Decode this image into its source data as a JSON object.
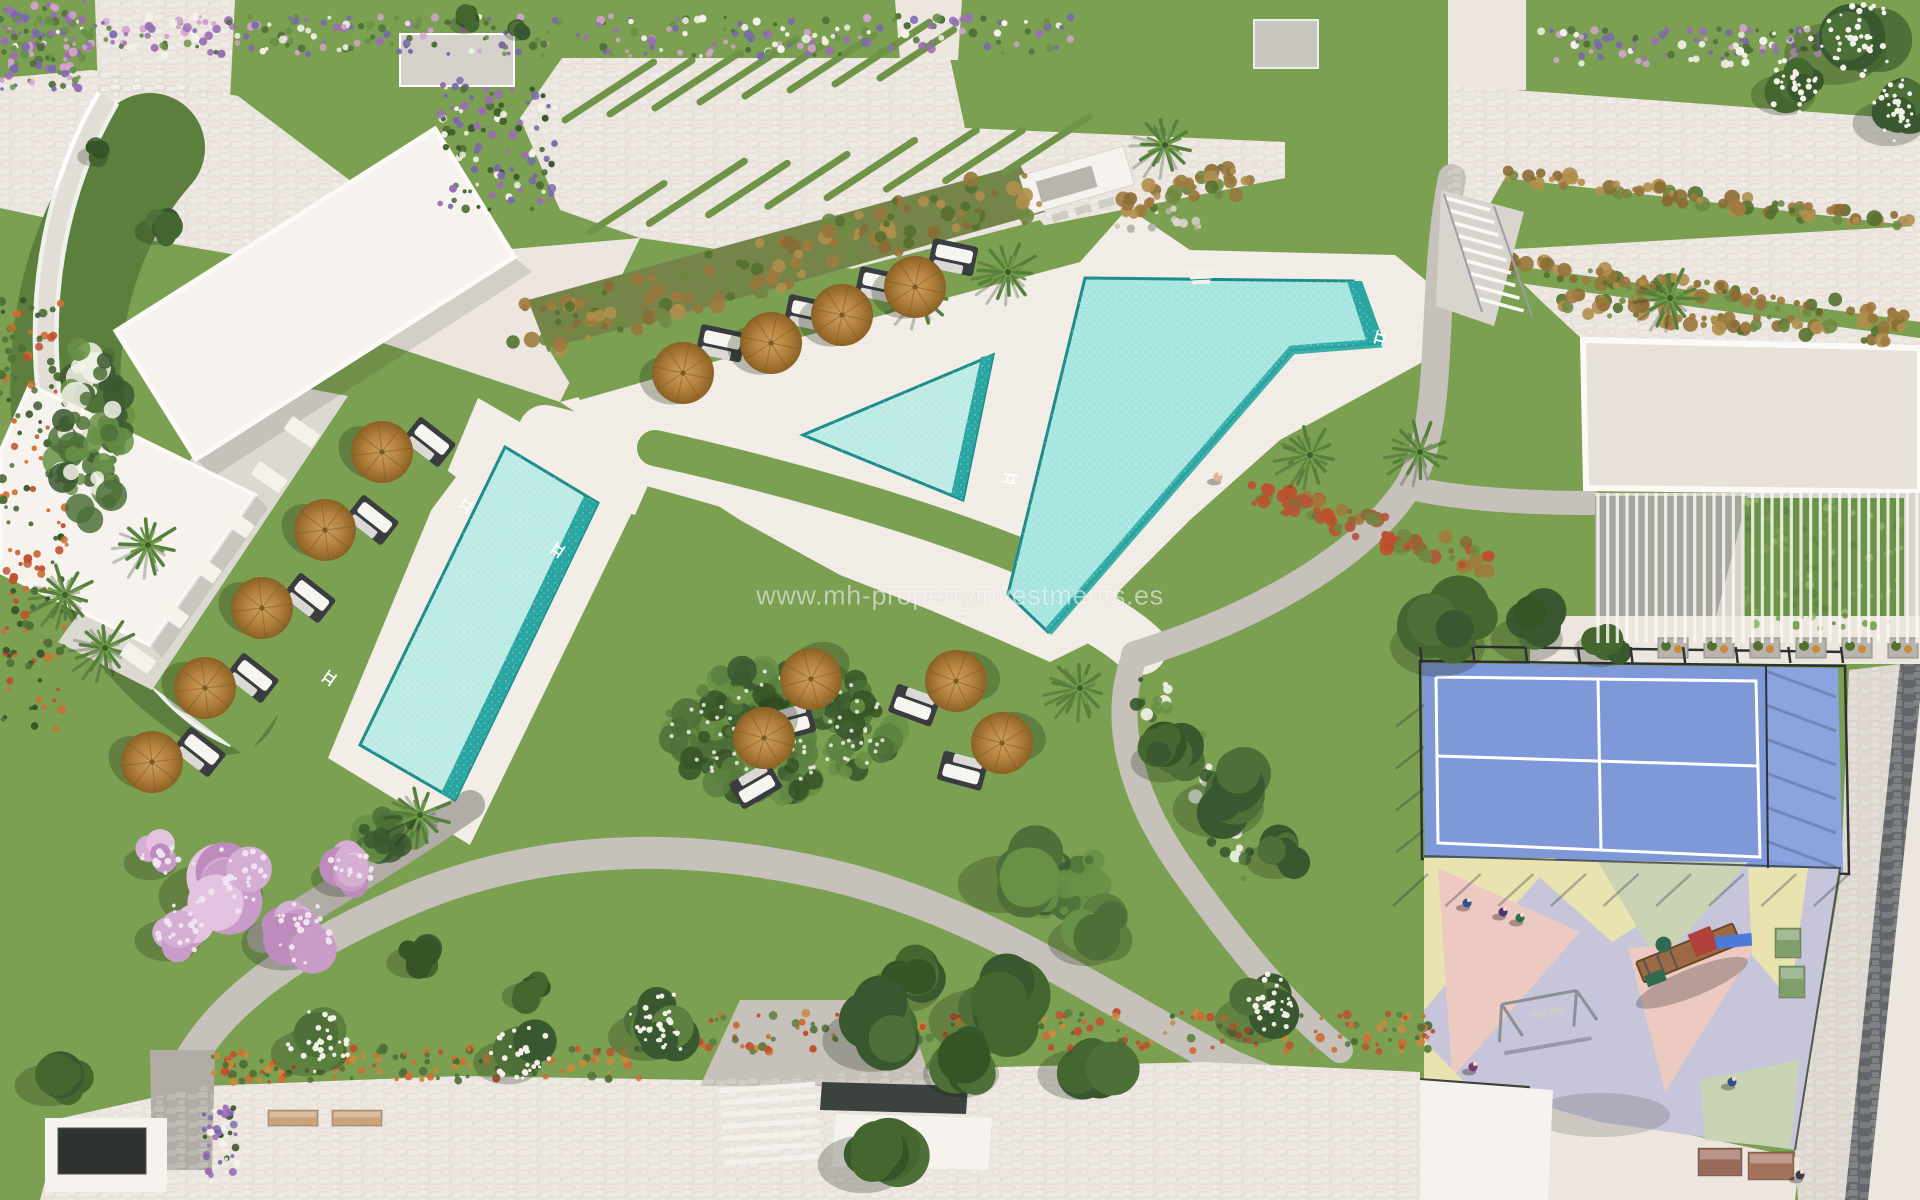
{
  "watermark": {
    "text": "www.mh-propertyinvestments.es"
  },
  "colors": {
    "grass": "#7ca051",
    "grassDark": "#5c7f3b",
    "paving": "#ece6df",
    "deck": "#f2ede6",
    "pathGray": "#c6c2bb",
    "pathDark": "#b1ada6",
    "cobbleLight": "#ded8d0",
    "cobbleDark": "#62666b",
    "poolLight": "#a7e6e0",
    "poolPale": "#bcebe5",
    "poolDeep": "#2aa6a2",
    "poolEdge": "#1d8c8a",
    "courtBlue": "#7e98d8",
    "courtBlue2": "#8ba3de",
    "courtLine": "#ffffff",
    "playLav": "#c6c5d9",
    "playYellow": "#e9e3af",
    "playPink": "#ecc9c1",
    "playSage": "#cbd3b5",
    "umbTop": "#b5813e",
    "umbDark": "#7e5a23",
    "mat": "#3a3d3f",
    "lounger": "#f7f5f0",
    "roofWhite": "#f6f3ee",
    "roofBeige": "#e7e1d9",
    "roofDark": "#3c423d",
    "boxGray": "#d5d2cc",
    "stripGreen": "#6f9447",
    "slope": "#75854a",
    "fence": "#2e3233",
    "watermark": "rgba(255,255,255,0.55)"
  },
  "scene": {
    "umbrellas": [
      {
        "x": 683,
        "y": 373,
        "a": 12
      },
      {
        "x": 771,
        "y": 343,
        "a": 12
      },
      {
        "x": 842,
        "y": 315,
        "a": 12
      },
      {
        "x": 915,
        "y": 287,
        "a": 12
      },
      {
        "x": 382,
        "y": 452,
        "a": 38
      },
      {
        "x": 325,
        "y": 530,
        "a": 38
      },
      {
        "x": 262,
        "y": 608,
        "a": 38
      },
      {
        "x": 205,
        "y": 688,
        "a": 38
      },
      {
        "x": 152,
        "y": 762,
        "a": 38
      },
      {
        "x": 811,
        "y": 679,
        "a": 165
      },
      {
        "x": 764,
        "y": 738,
        "a": 150
      },
      {
        "x": 956,
        "y": 681,
        "a": 200
      },
      {
        "x": 1002,
        "y": 743,
        "a": 195
      }
    ],
    "palms": [
      {
        "x": 148,
        "y": 545
      },
      {
        "x": 65,
        "y": 595
      },
      {
        "x": 105,
        "y": 648
      },
      {
        "x": 920,
        "y": 295
      },
      {
        "x": 1008,
        "y": 272
      },
      {
        "x": 1310,
        "y": 455
      },
      {
        "x": 1420,
        "y": 452
      },
      {
        "x": 1080,
        "y": 688
      },
      {
        "x": 1670,
        "y": 298
      },
      {
        "x": 1165,
        "y": 145
      },
      {
        "x": 420,
        "y": 815
      }
    ],
    "trees": [
      {
        "x": 1235,
        "y": 795,
        "r": 48,
        "t": "dark"
      },
      {
        "x": 1175,
        "y": 752,
        "r": 34,
        "t": "dark"
      },
      {
        "x": 1285,
        "y": 852,
        "r": 30,
        "t": "dark"
      },
      {
        "x": 1000,
        "y": 1005,
        "r": 55,
        "t": "dark"
      },
      {
        "x": 1092,
        "y": 1062,
        "r": 42,
        "t": "dark"
      },
      {
        "x": 918,
        "y": 978,
        "r": 38,
        "t": "dark"
      },
      {
        "x": 890,
        "y": 1025,
        "r": 52,
        "t": "dark"
      },
      {
        "x": 975,
        "y": 1062,
        "r": 40,
        "t": "dark"
      },
      {
        "x": 880,
        "y": 1150,
        "r": 48,
        "t": "dark"
      },
      {
        "x": 1455,
        "y": 632,
        "r": 50,
        "t": "dark"
      },
      {
        "x": 1540,
        "y": 628,
        "r": 38,
        "t": "dark"
      },
      {
        "x": 1610,
        "y": 642,
        "r": 28,
        "t": "dark"
      },
      {
        "x": 163,
        "y": 225,
        "r": 22,
        "t": "dark"
      },
      {
        "x": 98,
        "y": 152,
        "r": 16,
        "t": "dark"
      },
      {
        "x": 60,
        "y": 1075,
        "r": 35,
        "t": "dark"
      },
      {
        "x": 420,
        "y": 955,
        "r": 26,
        "t": "dark"
      },
      {
        "x": 530,
        "y": 990,
        "r": 22,
        "t": "dark"
      },
      {
        "x": 470,
        "y": 20,
        "r": 16,
        "t": "dark"
      },
      {
        "x": 520,
        "y": 30,
        "r": 12,
        "t": "dark"
      },
      {
        "x": 1852,
        "y": 38,
        "r": 52,
        "t": "mixed"
      },
      {
        "x": 1795,
        "y": 85,
        "r": 34,
        "t": "mixed"
      },
      {
        "x": 1902,
        "y": 112,
        "r": 38,
        "t": "mixed"
      },
      {
        "x": 230,
        "y": 880,
        "r": 55,
        "t": "pink"
      },
      {
        "x": 300,
        "y": 930,
        "r": 45,
        "t": "pink"
      },
      {
        "x": 180,
        "y": 930,
        "r": 35,
        "t": "pink"
      },
      {
        "x": 350,
        "y": 870,
        "r": 30,
        "t": "pink"
      },
      {
        "x": 160,
        "y": 855,
        "r": 28,
        "t": "pink"
      },
      {
        "x": 320,
        "y": 1042,
        "r": 38,
        "t": "white"
      },
      {
        "x": 520,
        "y": 1052,
        "r": 36,
        "t": "white"
      },
      {
        "x": 660,
        "y": 1025,
        "r": 40,
        "t": "white"
      },
      {
        "x": 1267,
        "y": 1008,
        "r": 40,
        "t": "white"
      },
      {
        "x": 1020,
        "y": 870,
        "r": 48,
        "t": "mid"
      },
      {
        "x": 1100,
        "y": 930,
        "r": 40,
        "t": "mid"
      }
    ],
    "flower_beds": [
      {
        "x": 0,
        "y": 16,
        "w": 1075,
        "h": 40,
        "n": 320,
        "c": [
          "#9b6db4",
          "#7a68ad",
          "#d2a3cc",
          "#f4f3ea",
          "#4e7038",
          "#679146"
        ]
      },
      {
        "x": 1540,
        "y": 28,
        "w": 280,
        "h": 36,
        "n": 100,
        "c": [
          "#9b6db4",
          "#7a68ad",
          "#d2a3cc",
          "#f4f3ea",
          "#4e7038"
        ]
      },
      {
        "x": 0,
        "y": 0,
        "w": 92,
        "h": 92,
        "n": 110,
        "c": [
          "#9b6db4",
          "#7a68ad",
          "#d2a3cc",
          "#4e7038",
          "#679146"
        ]
      },
      {
        "x": 440,
        "y": 80,
        "w": 115,
        "h": 130,
        "n": 110,
        "c": [
          "#9b6db4",
          "#7a68ad",
          "#f4f3ea",
          "#4e7038",
          "#365426"
        ]
      },
      {
        "x": 0,
        "y": 300,
        "w": 68,
        "h": 430,
        "n": 150,
        "c": [
          "#bf4f2e",
          "#cd6d35",
          "#4e7038",
          "#365426"
        ]
      },
      {
        "x": 210,
        "y": 1048,
        "w": 430,
        "h": 34,
        "n": 130,
        "c": [
          "#cd6d35",
          "#bf4f2e",
          "#c98a3a",
          "#4e7038"
        ]
      },
      {
        "x": 640,
        "y": 1012,
        "w": 800,
        "h": 40,
        "n": 230,
        "c": [
          "#cd6d35",
          "#bf4f2e",
          "#c98a3a",
          "#4e7038",
          "#5b8040"
        ]
      },
      {
        "x": 203,
        "y": 1105,
        "w": 36,
        "h": 78,
        "n": 40,
        "c": [
          "#9b6db4",
          "#7a68ad",
          "#f4f3ea",
          "#365426"
        ]
      },
      {
        "x": 1117,
        "y": 208,
        "w": 85,
        "h": 22,
        "n": 14,
        "c": [
          "#cfc9bf",
          "#b7b1a7",
          "#ddd8cf"
        ]
      },
      {
        "x": 1742,
        "y": 498,
        "w": 162,
        "h": 132,
        "n": 90,
        "c": [
          "#7da053",
          "#8fb261",
          "#5d8440"
        ]
      }
    ],
    "garden_blobs": [
      {
        "x": 780,
        "y": 730,
        "w": 230,
        "h": 130,
        "n": 150,
        "c": [
          "#3a5830",
          "#4e7038",
          "#679146",
          "#365426",
          "#5b8040"
        ]
      },
      {
        "x": 780,
        "y": 730,
        "w": 220,
        "h": 120,
        "n": 90,
        "c": [
          "#f2f2e8"
        ],
        "r": 2
      },
      {
        "x": 1060,
        "y": 880,
        "w": 90,
        "h": 70,
        "n": 40,
        "c": [
          "#3a5830",
          "#4e7038",
          "#679146"
        ]
      },
      {
        "x": 90,
        "y": 430,
        "w": 70,
        "h": 180,
        "n": 90,
        "c": [
          "#3a5830",
          "#4e7038",
          "#679146",
          "#f2f2e8"
        ]
      },
      {
        "x": 390,
        "y": 835,
        "w": 60,
        "h": 40,
        "n": 30,
        "c": [
          "#3a5830",
          "#4e7038",
          "#679146"
        ]
      }
    ],
    "shrub_lines": [
      {
        "x0": 537,
        "y0": 330,
        "x1": 1025,
        "y1": 195,
        "n": 150,
        "s": 26
      },
      {
        "x0": 1130,
        "y0": 205,
        "x1": 1240,
        "y1": 178,
        "n": 40,
        "s": 14
      },
      {
        "x0": 1505,
        "y0": 175,
        "x1": 1915,
        "y1": 224,
        "n": 80,
        "s": 8
      },
      {
        "x0": 1458,
        "y0": 256,
        "x1": 1915,
        "y1": 320,
        "n": 90,
        "s": 9
      },
      {
        "x0": 1548,
        "y0": 300,
        "x1": 1898,
        "y1": 338,
        "n": 70,
        "s": 10
      },
      {
        "x0": 1250,
        "y0": 490,
        "x1": 1485,
        "y1": 565,
        "n": 80,
        "s": 13,
        "c": [
          "#a07a3e",
          "#b5543a",
          "#bf4f2e",
          "#6f8a43",
          "#8a6b35"
        ]
      },
      {
        "x0": 1150,
        "y0": 690,
        "x1": 1260,
        "y1": 880,
        "n": 60,
        "s": 18,
        "c": [
          "#4e7038",
          "#679146",
          "#3a5830",
          "#f2f2e8"
        ]
      }
    ],
    "grass_strip_rows": [
      {
        "x0": 565,
        "y0": 120,
        "x1": 880,
        "y1": 78,
        "n": 8
      },
      {
        "x0": 590,
        "y0": 232,
        "x1": 1005,
        "y1": 172,
        "n": 8
      }
    ],
    "terrace_pads": {
      "x0": 302,
      "y0": 432,
      "x1": 138,
      "y1": 658,
      "n": 6
    },
    "people": [
      {
        "x": 1467,
        "y": 903,
        "c": "#31548f"
      },
      {
        "x": 1503,
        "y": 912,
        "c": "#49356b"
      },
      {
        "x": 1520,
        "y": 918,
        "c": "#2f6b4f"
      },
      {
        "x": 1473,
        "y": 1067,
        "c": "#7a3d6a"
      },
      {
        "x": 1732,
        "y": 1082,
        "c": "#2f4f8a"
      },
      {
        "x": 1800,
        "y": 1175,
        "c": "#3c3c44"
      },
      {
        "x": 1218,
        "y": 477,
        "c": "#d9b394"
      }
    ],
    "planters_top": {
      "x0": 1658,
      "y": 638,
      "n": 6,
      "dx": 46
    },
    "bench_planters": [
      {
        "x": 1775,
        "y": 928,
        "w": 26,
        "h": 30,
        "f": "#7f9e6a"
      },
      {
        "x": 1779,
        "y": 966,
        "w": 26,
        "h": 32,
        "f": "#7f9e6a"
      },
      {
        "x": 1698,
        "y": 1148,
        "w": 44,
        "h": 28,
        "f": "#9a6a58"
      },
      {
        "x": 1748,
        "y": 1152,
        "w": 46,
        "h": 28,
        "f": "#a3705c"
      },
      {
        "x": 268,
        "y": 1110,
        "w": 50,
        "h": 16,
        "f": "#caa27c"
      },
      {
        "x": 332,
        "y": 1110,
        "w": 50,
        "h": 16,
        "f": "#caa27c"
      }
    ],
    "ladders": [
      {
        "x": 1378,
        "y": 330,
        "a": 15
      },
      {
        "x": 1018,
        "y": 476,
        "a": 100
      },
      {
        "x": 467,
        "y": 497,
        "a": 35
      },
      {
        "x": 557,
        "y": 558,
        "a": 215
      },
      {
        "x": 330,
        "y": 670,
        "a": 35
      }
    ],
    "stairs": {
      "x": 1446,
      "y": 198,
      "n": 9,
      "dx": 4.2,
      "dy": 12.6,
      "len": 44
    },
    "pergola_slats": {
      "x": 1595,
      "y": 493,
      "w": 325,
      "h": 150,
      "n": 34
    },
    "court": {
      "left": 1422,
      "top": 663,
      "right": 1843,
      "bottom": 872,
      "posts": 9,
      "innerRight": 1766
    }
  }
}
